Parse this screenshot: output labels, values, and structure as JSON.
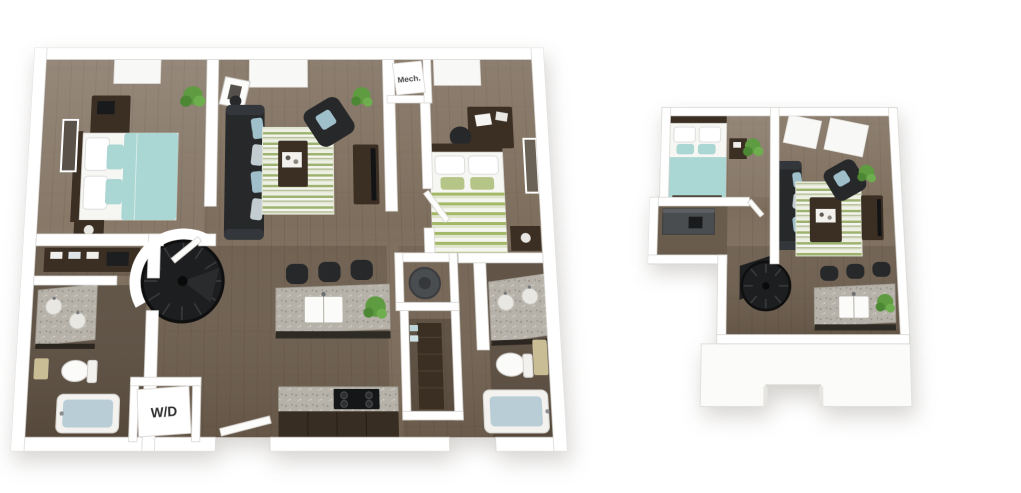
{
  "labels": {
    "mech_closet": "Mech.",
    "washer_dryer": "W/D"
  },
  "colors": {
    "background": "#ffffff",
    "wall": "#ffffff",
    "wall_edge": "#d6d5d1",
    "floor_wood": "#7e6e5d",
    "floor_bath": "#5e5144",
    "granite_base": "#b6b2a9",
    "furniture_dark": "#26282a",
    "furniture_wood": "#3b2f24",
    "bedding_teal": "#aad6d3",
    "bedding_white": "#f6f6f3",
    "pillow_blue": "#9fc0cb",
    "stripe_green": "#9cb26e",
    "stripe_light": "#eef0e4",
    "bed2_stripe_green": "#a3b968",
    "plant_green": "#5f9b40",
    "tub_blue": "#b8cdd5",
    "towel_tan": "#c9bd96",
    "appliance_gray": "#4a4d50",
    "label_text": "#2f2f2f"
  }
}
